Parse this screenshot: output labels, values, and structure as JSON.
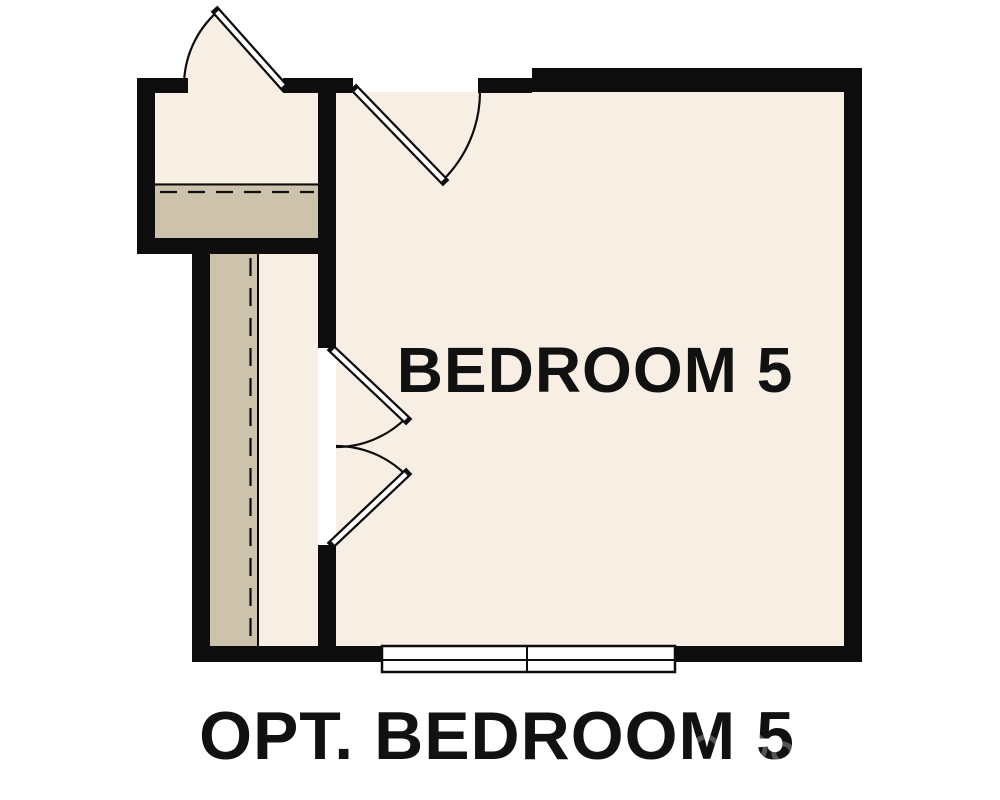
{
  "title": {
    "room_label": "BEDROOM 5",
    "caption": "OPT. BEDROOM 5"
  },
  "colors": {
    "floor": "#f7efe3",
    "tan": "#cdc2ac",
    "wall": "#0d0d0d",
    "text": "#111111",
    "frame": "#ffffff"
  },
  "features": [
    {
      "name": "closet-door-top-left",
      "type": "hinged-door-swing-out"
    },
    {
      "name": "bedroom-entry-door",
      "type": "hinged-door-swing-in"
    },
    {
      "name": "double-doors-left",
      "type": "double-hinged-doors"
    },
    {
      "name": "bottom-window",
      "type": "double-pane-window"
    },
    {
      "name": "overhead-dashed-lines",
      "type": "dashed-ceiling-break-lines"
    }
  ]
}
